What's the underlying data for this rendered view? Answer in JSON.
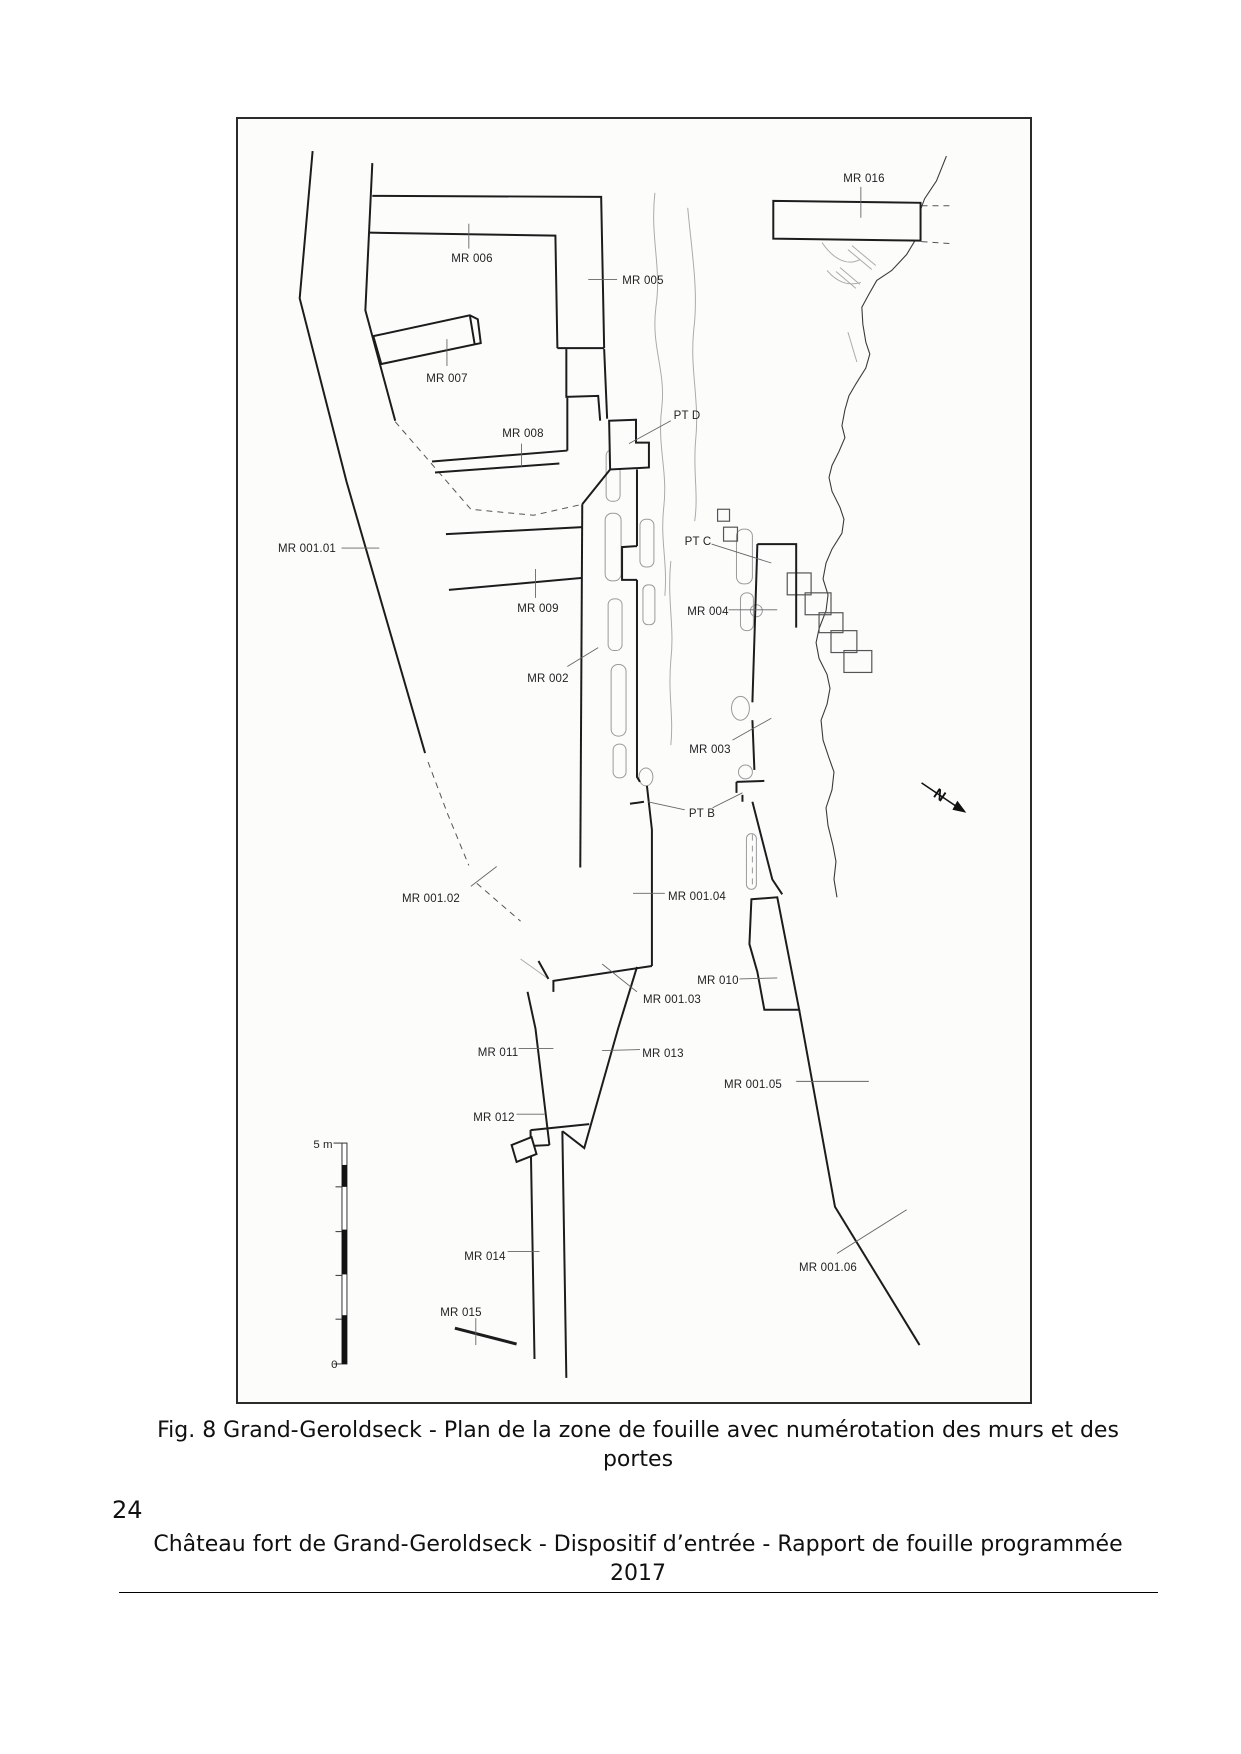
{
  "page": {
    "number": "24",
    "caption": "Fig. 8 Grand-Geroldseck - Plan de la zone de fouille avec numérotation des murs et des portes",
    "footer": "Château fort de Grand-Geroldseck - Dispositif d’entrée - Rapport de fouille programmée 2017"
  },
  "plan": {
    "north_arrow_letter": "N",
    "scale_bar": {
      "top_label": "5 m",
      "bottom_label": "0"
    },
    "colors": {
      "wall": "#1c1c1c",
      "leader": "#666666",
      "contour": "#9a9a9a",
      "terrain": "#3a3a3a"
    },
    "labels": [
      {
        "id": "mr016",
        "text": "MR 016",
        "x": 862,
        "y": 177
      },
      {
        "id": "mr006",
        "text": "MR 006",
        "x": 470,
        "y": 257
      },
      {
        "id": "mr005",
        "text": "MR 005",
        "x": 641,
        "y": 279
      },
      {
        "id": "mr007",
        "text": "MR 007",
        "x": 445,
        "y": 377
      },
      {
        "id": "mr008",
        "text": "MR 008",
        "x": 521,
        "y": 432
      },
      {
        "id": "ptd",
        "text": "PT D",
        "x": 685,
        "y": 414
      },
      {
        "id": "mr00101",
        "text": "MR 001.01",
        "x": 305,
        "y": 547
      },
      {
        "id": "ptc",
        "text": "PT C",
        "x": 696,
        "y": 540
      },
      {
        "id": "mr009",
        "text": "MR 009",
        "x": 536,
        "y": 607
      },
      {
        "id": "mr004",
        "text": "MR 004",
        "x": 706,
        "y": 610
      },
      {
        "id": "mr002",
        "text": "MR 002",
        "x": 546,
        "y": 677
      },
      {
        "id": "mr003",
        "text": "MR 003",
        "x": 708,
        "y": 748
      },
      {
        "id": "ptb",
        "text": "PT B",
        "x": 700,
        "y": 812
      },
      {
        "id": "mr00104",
        "text": "MR 001.04",
        "x": 695,
        "y": 895
      },
      {
        "id": "mr00102",
        "text": "MR 001.02",
        "x": 429,
        "y": 897
      },
      {
        "id": "mr010",
        "text": "MR 010",
        "x": 716,
        "y": 979
      },
      {
        "id": "mr00103",
        "text": "MR 001.03",
        "x": 670,
        "y": 998
      },
      {
        "id": "mr011",
        "text": "MR 011",
        "x": 496,
        "y": 1051
      },
      {
        "id": "mr013",
        "text": "MR 013",
        "x": 661,
        "y": 1052
      },
      {
        "id": "mr012",
        "text": "MR 012",
        "x": 492,
        "y": 1116
      },
      {
        "id": "mr00105",
        "text": "MR 001.05",
        "x": 751,
        "y": 1083
      },
      {
        "id": "mr014",
        "text": "MR 014",
        "x": 483,
        "y": 1255
      },
      {
        "id": "mr00106",
        "text": "MR 001.06",
        "x": 826,
        "y": 1266
      },
      {
        "id": "mr015",
        "text": "MR 015",
        "x": 459,
        "y": 1311
      }
    ],
    "leaders": [
      {
        "for": "mr016",
        "points": [
          862,
          184,
          862,
          215
        ]
      },
      {
        "for": "mr006",
        "points": [
          468,
          221,
          468,
          246
        ]
      },
      {
        "for": "mr005",
        "points": [
          588,
          277,
          617,
          277
        ]
      },
      {
        "for": "mr007",
        "points": [
          446,
          337,
          446,
          364
        ]
      },
      {
        "for": "mr008",
        "points": [
          521,
          442,
          521,
          465
        ]
      },
      {
        "for": "ptd",
        "points": [
          671,
          419,
          629,
          442
        ]
      },
      {
        "for": "mr00101",
        "points": [
          340,
          547,
          378,
          547
        ]
      },
      {
        "for": "ptc",
        "points": [
          712,
          543,
          772,
          562
        ]
      },
      {
        "for": "mr009",
        "points": [
          535,
          568,
          535,
          597
        ]
      },
      {
        "for": "mr004",
        "points": [
          729,
          609,
          778,
          609
        ]
      },
      {
        "for": "mr002",
        "points": [
          567,
          666,
          598,
          647
        ]
      },
      {
        "for": "mr003",
        "points": [
          733,
          740,
          772,
          718
        ]
      },
      {
        "for": "ptb",
        "points": [
          685,
          810,
          648,
          802
        ]
      },
      {
        "for": "ptb",
        "points": [
          713,
          808,
          743,
          793
        ]
      },
      {
        "for": "mr00104",
        "points": [
          633,
          894,
          665,
          894
        ]
      },
      {
        "for": "mr00102",
        "points": [
          470,
          887,
          496,
          867
        ]
      },
      {
        "for": "mr010",
        "points": [
          740,
          980,
          778,
          979
        ]
      },
      {
        "for": "mr00103",
        "points": [
          637,
          993,
          602,
          965
        ]
      },
      {
        "for": "mr011",
        "points": [
          518,
          1050,
          553,
          1050
        ]
      },
      {
        "for": "mr013",
        "points": [
          602,
          1052,
          640,
          1051
        ]
      },
      {
        "for": "mr012",
        "points": [
          516,
          1116,
          544,
          1116
        ]
      },
      {
        "for": "mr00105",
        "points": [
          797,
          1083,
          870,
          1083
        ]
      },
      {
        "for": "mr014",
        "points": [
          507,
          1254,
          539,
          1254
        ]
      },
      {
        "for": "mr00106",
        "points": [
          838,
          1256,
          908,
          1212
        ]
      },
      {
        "for": "mr015",
        "points": [
          475,
          1321,
          475,
          1348
        ]
      }
    ]
  }
}
